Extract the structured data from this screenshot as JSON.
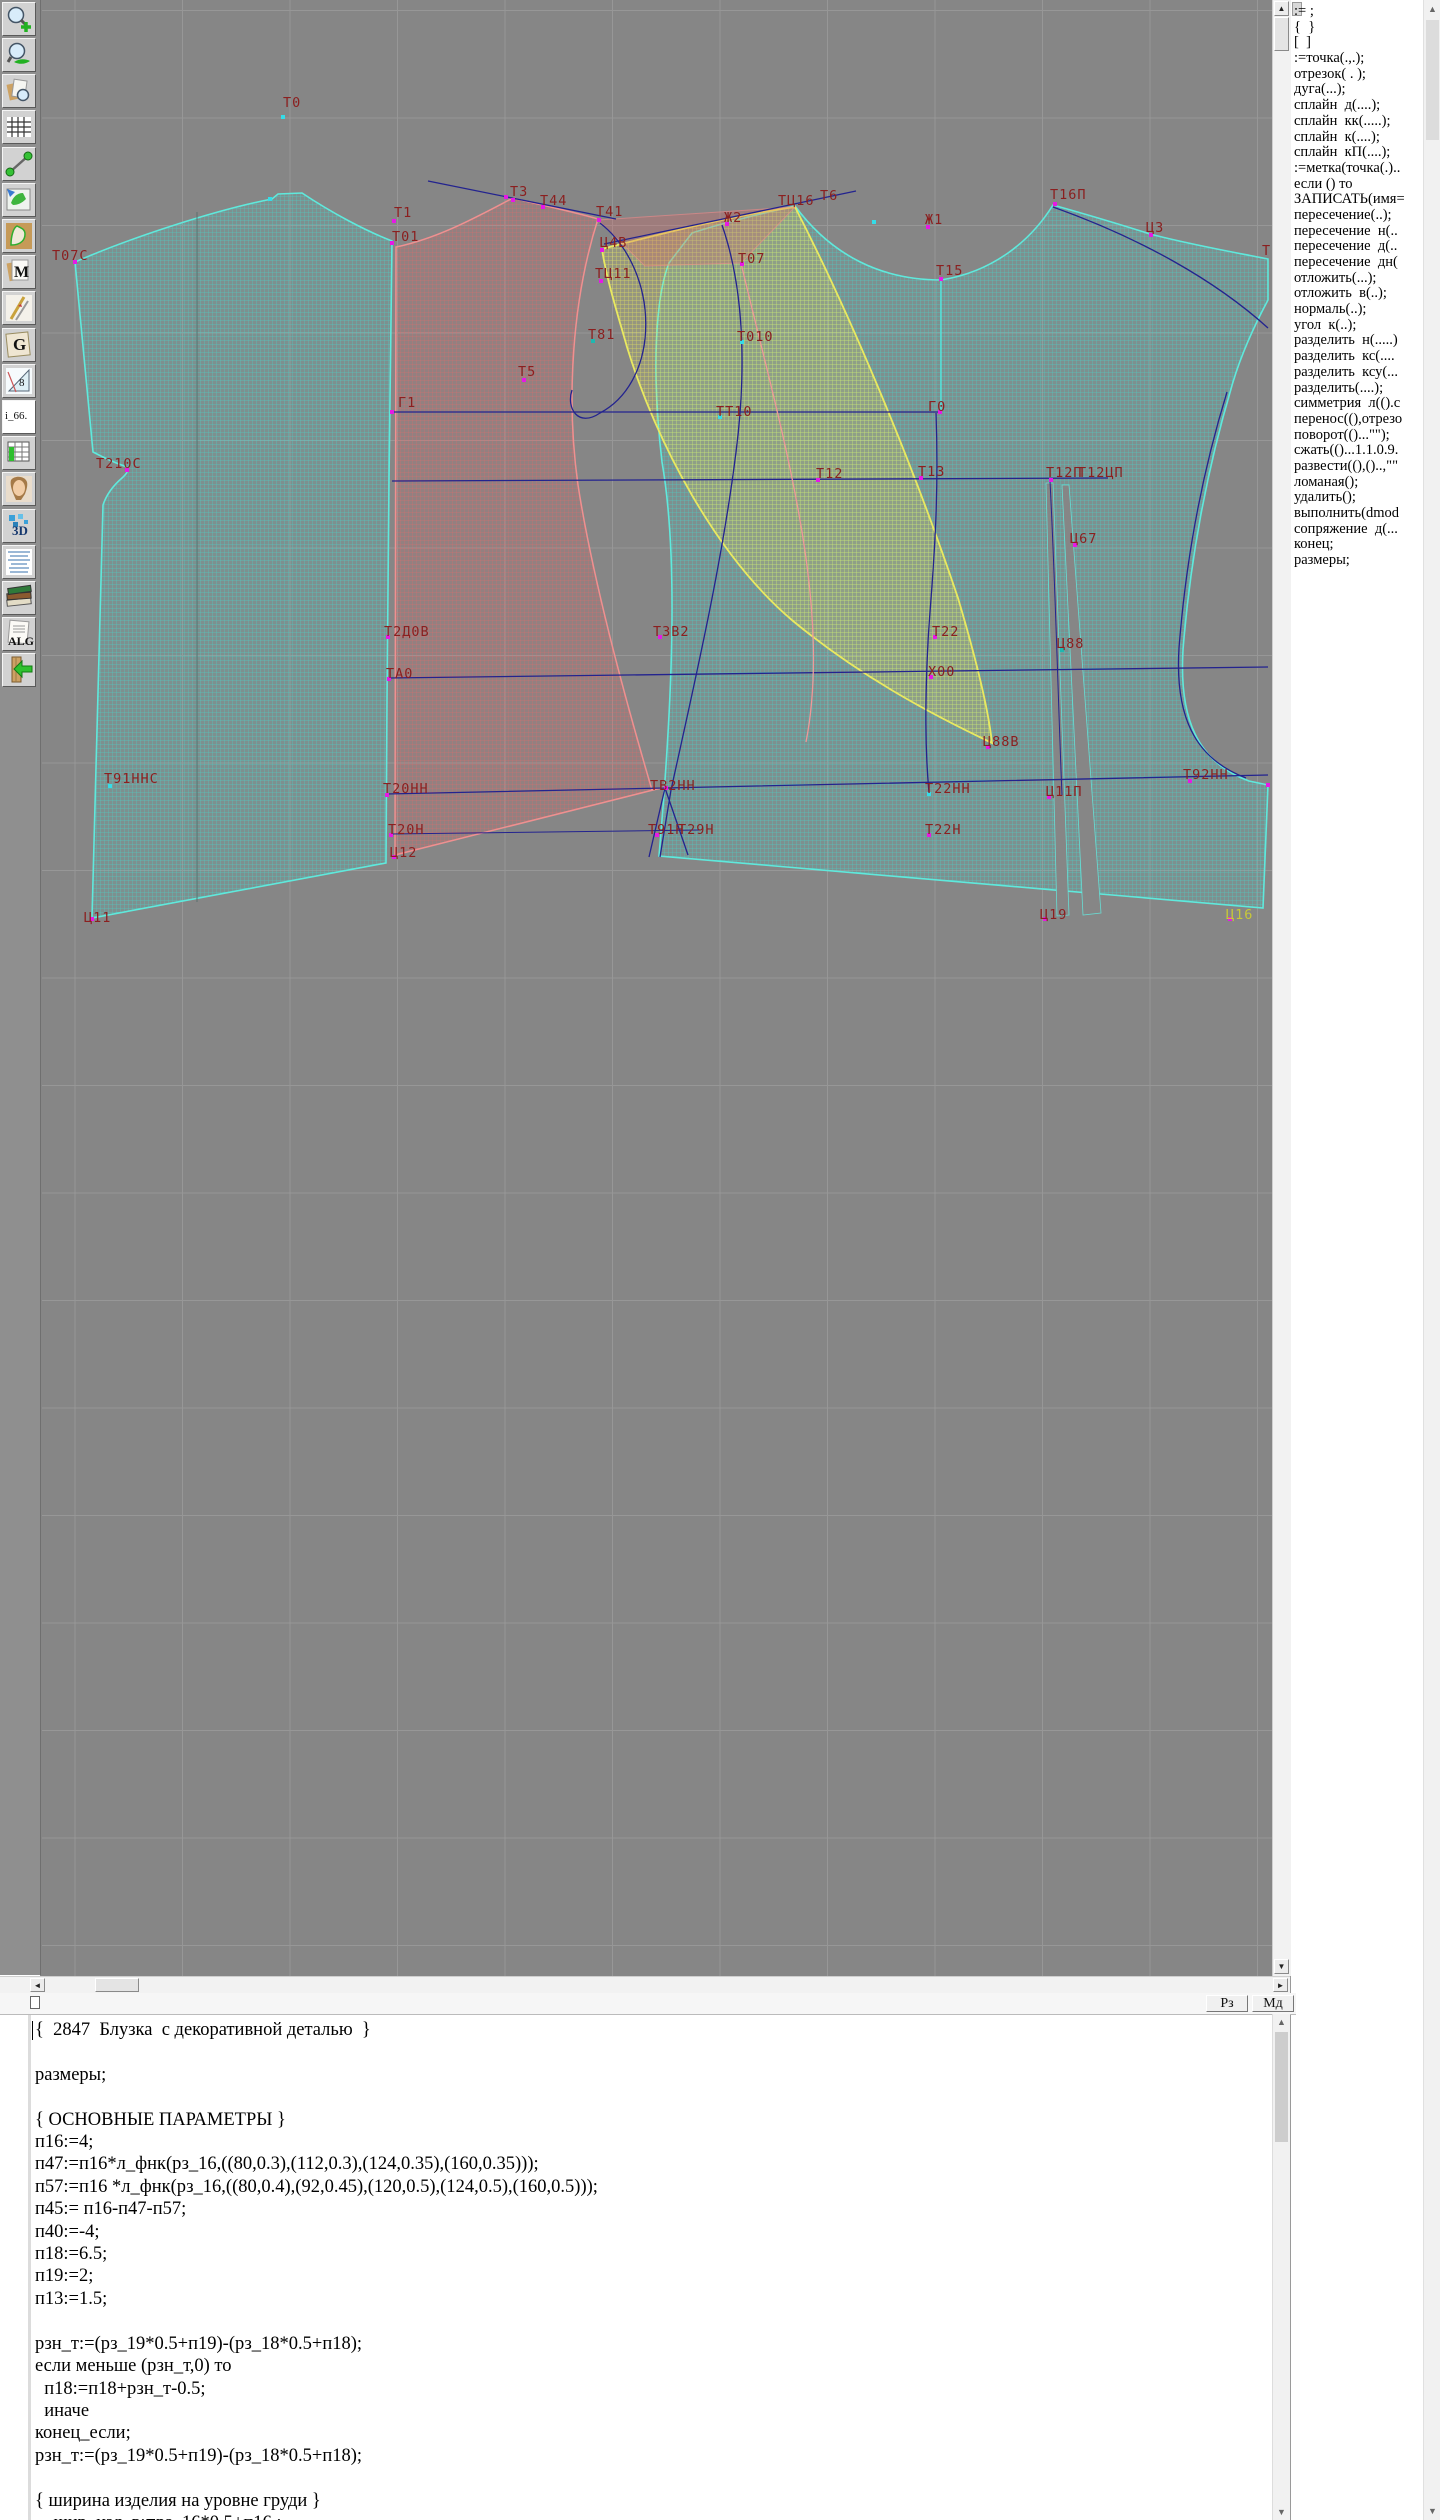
{
  "toolbar": {
    "labels": {
      "m": "M",
      "g": "G",
      "eight": "8",
      "i66": "i_66.",
      "threeD": "3D",
      "alg": "ALG"
    }
  },
  "canvas": {
    "bg": "#868686",
    "grid_color": "#979797",
    "grid_step": 107.5,
    "label_color": "#8b1f1f",
    "labels": [
      {
        "t": "Т0",
        "x": 283,
        "y": 107
      },
      {
        "t": "Т07С",
        "x": 52,
        "y": 260
      },
      {
        "t": "Т210С",
        "x": 96,
        "y": 468
      },
      {
        "t": "Т91ННС",
        "x": 104,
        "y": 783
      },
      {
        "t": "Ц11",
        "x": 84,
        "y": 922
      },
      {
        "t": "Т1",
        "x": 394,
        "y": 217
      },
      {
        "t": "Т01",
        "x": 392,
        "y": 241
      },
      {
        "t": "Г1",
        "x": 398,
        "y": 407
      },
      {
        "t": "Т3",
        "x": 510,
        "y": 196
      },
      {
        "t": "Т44",
        "x": 540,
        "y": 205
      },
      {
        "t": "Т41",
        "x": 596,
        "y": 216
      },
      {
        "t": "Ц4В",
        "x": 600,
        "y": 247
      },
      {
        "t": "ТЦ11",
        "x": 595,
        "y": 278
      },
      {
        "t": "Т81",
        "x": 588,
        "y": 339
      },
      {
        "t": "Т5",
        "x": 518,
        "y": 376
      },
      {
        "t": "Т2Д0В",
        "x": 384,
        "y": 636
      },
      {
        "t": "ТА0",
        "x": 386,
        "y": 678
      },
      {
        "t": "Т20НН",
        "x": 383,
        "y": 793
      },
      {
        "t": "Т20Н",
        "x": 388,
        "y": 834
      },
      {
        "t": "Ц12",
        "x": 390,
        "y": 857
      },
      {
        "t": "Ж2",
        "x": 724,
        "y": 222
      },
      {
        "t": "Т07",
        "x": 738,
        "y": 263
      },
      {
        "t": "Т010",
        "x": 737,
        "y": 341
      },
      {
        "t": "ТТ10",
        "x": 716,
        "y": 416
      },
      {
        "t": "Т12",
        "x": 816,
        "y": 478
      },
      {
        "t": "Т13",
        "x": 918,
        "y": 476
      },
      {
        "t": "ТЗВ2",
        "x": 653,
        "y": 636
      },
      {
        "t": "ТВ2НН",
        "x": 650,
        "y": 790
      },
      {
        "t": "Т91Н",
        "x": 648,
        "y": 834
      },
      {
        "t": "Т29Н",
        "x": 678,
        "y": 834
      },
      {
        "t": "Т22",
        "x": 932,
        "y": 636
      },
      {
        "t": "Х00",
        "x": 928,
        "y": 676
      },
      {
        "t": "Т22НН",
        "x": 925,
        "y": 793
      },
      {
        "t": "Т22Н",
        "x": 925,
        "y": 834
      },
      {
        "t": "Ц88В",
        "x": 983,
        "y": 746
      },
      {
        "t": "Ц88",
        "x": 1057,
        "y": 648
      },
      {
        "t": "Ц67",
        "x": 1070,
        "y": 543
      },
      {
        "t": "Т12П",
        "x": 1046,
        "y": 477
      },
      {
        "t": "Т12ЦП",
        "x": 1078,
        "y": 477
      },
      {
        "t": "Ц11П",
        "x": 1046,
        "y": 796
      },
      {
        "t": "Т92НН",
        "x": 1183,
        "y": 779
      },
      {
        "t": "Ц19",
        "x": 1040,
        "y": 919
      },
      {
        "t": "Ц16",
        "x": 1226,
        "y": 919,
        "c": "#c8c838"
      },
      {
        "t": "ТЦ16",
        "x": 778,
        "y": 205
      },
      {
        "t": "Т6",
        "x": 820,
        "y": 200
      },
      {
        "t": "Ж1",
        "x": 925,
        "y": 224
      },
      {
        "t": "Т15",
        "x": 936,
        "y": 275
      },
      {
        "t": "Г0",
        "x": 928,
        "y": 411
      },
      {
        "t": "Т16П",
        "x": 1050,
        "y": 199
      },
      {
        "t": "Ц3",
        "x": 1146,
        "y": 232
      },
      {
        "t": "Т",
        "x": 1262,
        "y": 255
      }
    ],
    "points": [
      [
        283,
        117,
        "#35dce8"
      ],
      [
        75,
        262
      ],
      [
        127,
        470
      ],
      [
        110,
        786,
        "#35dce8"
      ],
      [
        92,
        919
      ],
      [
        394,
        221
      ],
      [
        392,
        243
      ],
      [
        513,
        200
      ],
      [
        543,
        207
      ],
      [
        599,
        220
      ],
      [
        602,
        250
      ],
      [
        601,
        281
      ],
      [
        593,
        341,
        "#1fb8b0"
      ],
      [
        524,
        380
      ],
      [
        388,
        637
      ],
      [
        389,
        679
      ],
      [
        387,
        795
      ],
      [
        391,
        835
      ],
      [
        394,
        857
      ],
      [
        727,
        224
      ],
      [
        742,
        264
      ],
      [
        742,
        342,
        "#35dce8"
      ],
      [
        720,
        417,
        "#35dce8"
      ],
      [
        818,
        480
      ],
      [
        921,
        478
      ],
      [
        660,
        637
      ],
      [
        666,
        788
      ],
      [
        657,
        835
      ],
      [
        935,
        637
      ],
      [
        931,
        677
      ],
      [
        929,
        794,
        "#35dce8"
      ],
      [
        929,
        835
      ],
      [
        988,
        747
      ],
      [
        1062,
        650,
        "#1fb8b0"
      ],
      [
        1075,
        545
      ],
      [
        1051,
        480
      ],
      [
        1049,
        797
      ],
      [
        1190,
        781
      ],
      [
        1045,
        919
      ],
      [
        1230,
        919
      ],
      [
        928,
        227
      ],
      [
        941,
        279
      ],
      [
        1055,
        204
      ],
      [
        1151,
        235
      ],
      [
        940,
        412
      ],
      [
        392,
        412
      ],
      [
        270,
        199,
        "#35dce8"
      ],
      [
        506,
        197
      ],
      [
        874,
        222,
        "#35dce8"
      ],
      [
        1268,
        785
      ]
    ]
  },
  "panel": {
    "items": [
      ":= ;",
      "{  }",
      "[  ]",
      ":=точка(.,.);",
      "отрезок( . );",
      "дуга(...);",
      "сплайн  д(....);",
      "сплайн  кк(.....);",
      "сплайн  к(....);",
      "сплайн  кП(....);",
      ":=метка(точка(.)..",
      "если () то",
      "ЗАПИСАТЬ(имя=",
      "пересечение(..);",
      "пересечение  н(..",
      "пересечение  д(..",
      "пересечение  дн(",
      "отложить(...);",
      "отложить  в(..);",
      "нормаль(..);",
      "угол  к(..);",
      "разделить  н(.....)",
      "разделить  кс(....",
      "разделить  ксу(...",
      "разделить(....);",
      "симметрия  л(().с",
      "перенос((),отрезо",
      "поворот(()...\"\");",
      "сжать(()...1.1.0.9.",
      "развести((),()..,\"\"",
      "ломаная();",
      "удалить();",
      "выполнить(dmod",
      "сопряжение  д(...",
      "конец;",
      "размеры;"
    ]
  },
  "statusbar": {
    "buttons": [
      "Рз",
      "Мд"
    ]
  },
  "editor": {
    "lines": [
      "{  2847  Блузка  с декоративной деталью  }",
      "",
      "размеры;",
      "",
      "{ ОСНОВНЫЕ ПАРАМЕТРЫ }",
      "п16:=4;",
      "п47:=п16*л_фнк(рз_16,((80,0.3),(112,0.3),(124,0.35),(160,0.35)));",
      "п57:=п16 *л_фнк(рз_16,((80,0.4),(92,0.45),(120,0.5),(124,0.5),(160,0.5)));",
      "п45:= п16-п47-п57;",
      "п40:=-4;",
      "п18:=6.5;",
      "п19:=2;",
      "п13:=1.5;",
      "",
      "рзн_т:=(рз_19*0.5+п19)-(рз_18*0.5+п18);",
      "если меньше (рзн_т,0) то",
      "  п18:=п18+рзн_т-0.5;",
      "  иначе",
      "конец_если;",
      "рзн_т:=(рз_19*0.5+п19)-(рз_18*0.5+п18);",
      "",
      "{ ширина изделия на уровне груди }",
      "    шир_изд_в:=рз_16*0.5+п16 ;"
    ]
  }
}
